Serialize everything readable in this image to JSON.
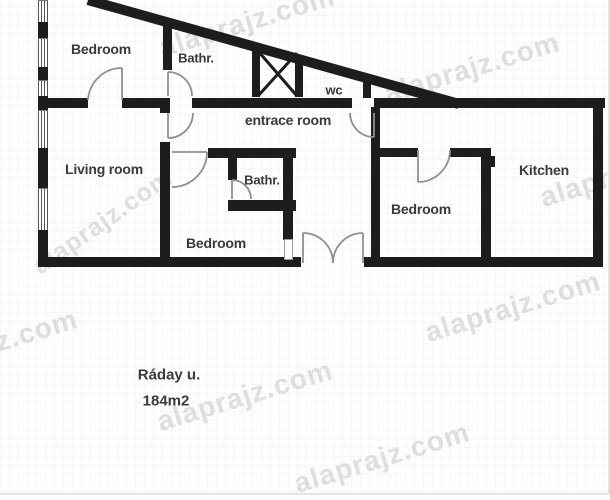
{
  "plan": {
    "street": "Ráday u.",
    "area": "184m2",
    "watermark": "alaprajz.com",
    "rooms": [
      {
        "id": "bedroom-top-left",
        "label": "Bedroom"
      },
      {
        "id": "bathroom-top",
        "label": "Bathr."
      },
      {
        "id": "wc",
        "label": "wc"
      },
      {
        "id": "entrance-room",
        "label": "entrace room"
      },
      {
        "id": "living-room",
        "label": "Living room"
      },
      {
        "id": "bathroom-middle",
        "label": "Bathr."
      },
      {
        "id": "bedroom-middle",
        "label": "Bedroom"
      },
      {
        "id": "bedroom-right",
        "label": "Bedroom"
      },
      {
        "id": "kitchen",
        "label": "Kitchen"
      }
    ],
    "colors": {
      "wall": "#1d1d1d",
      "door_arc": "#8f8f8f",
      "label_text": "#3a3a3a",
      "watermark_gray": "#c9c9c9"
    }
  }
}
